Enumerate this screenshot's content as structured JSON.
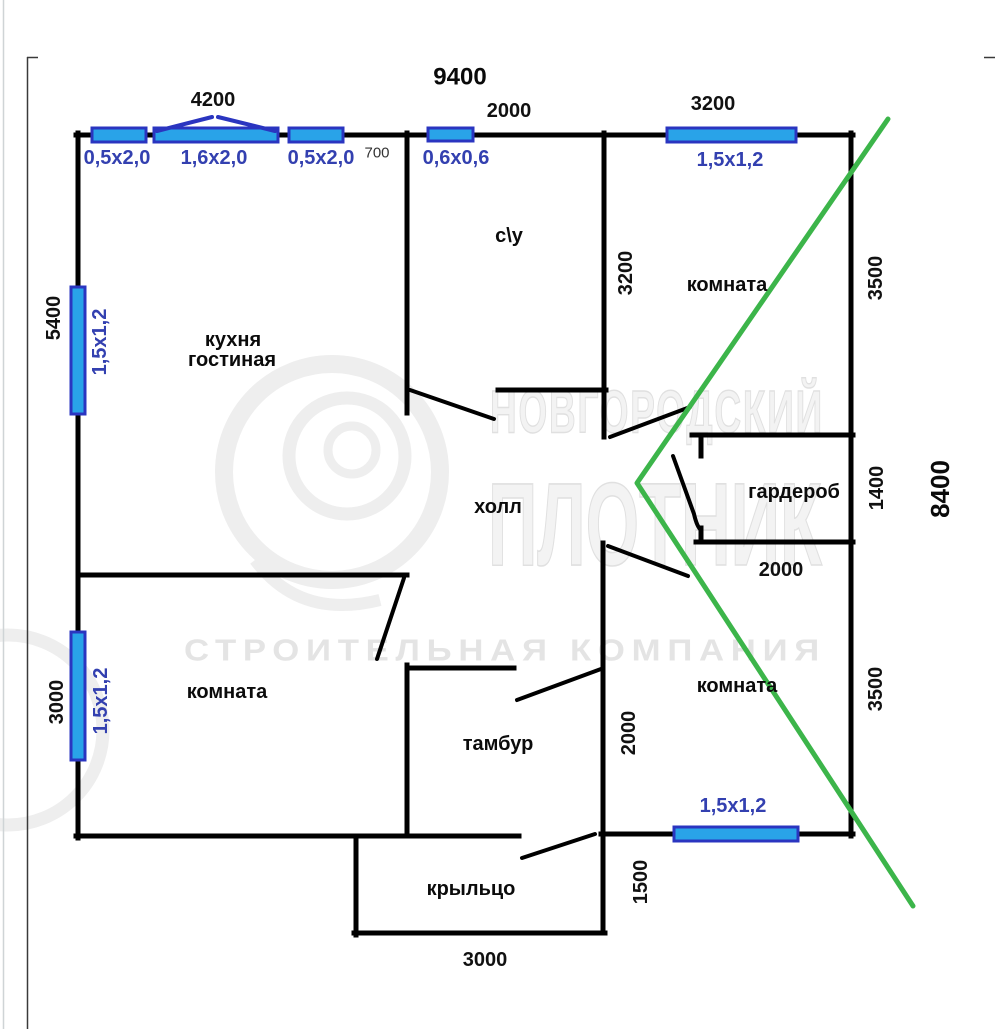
{
  "colors": {
    "wall": "#000000",
    "door": "#000000",
    "window_fill": "#29a3e8",
    "window_border": "#2a35c0",
    "window_label": "#3340b0",
    "roof_line": "#3cb54a",
    "frame": "#3a3a3a",
    "page_border": "#cfd4d6"
  },
  "watermark": {
    "brand_line1": "НОВГОРОДСКИЙ",
    "brand_line2": "ПЛОТНИК",
    "brand_line3": "СТРОИТЕЛЬНАЯ КОМПАНИЯ"
  },
  "plan": {
    "overall_width": "9400",
    "overall_height": "8400",
    "rooms": {
      "kitchen_line1": "кухня",
      "kitchen_line2": "гостиная",
      "bathroom": "c\\y",
      "room_top_right": "комната",
      "hall": "холл",
      "wardrobe": "гардероб",
      "room_bottom_left": "комната",
      "tambour": "тамбур",
      "room_bottom_right": "комната",
      "porch": "крыльцо"
    },
    "dimensions": {
      "top_4200": "4200",
      "top_2000": "2000",
      "top_3200": "3200",
      "wall_700": "700",
      "left_5400": "5400",
      "left_3000": "3000",
      "right_3500_top": "3500",
      "right_1400": "1400",
      "right_3500_bottom": "3500",
      "inner_3200": "3200",
      "inner_2000_wardrobe": "2000",
      "inner_2000_tambour": "2000",
      "bottom_1500": "1500",
      "bottom_3000": "3000"
    },
    "windows": {
      "top_left_small": "0,5x2,0",
      "top_bay": "1,6x2,0",
      "top_right_small": "0,5x2,0",
      "bath_window": "0,6x0,6",
      "top_room_window": "1,5x1,2",
      "left_upper": "1,5x1,2",
      "left_lower": "1,5x1,2",
      "bottom_room_window": "1,5x1,2"
    }
  }
}
